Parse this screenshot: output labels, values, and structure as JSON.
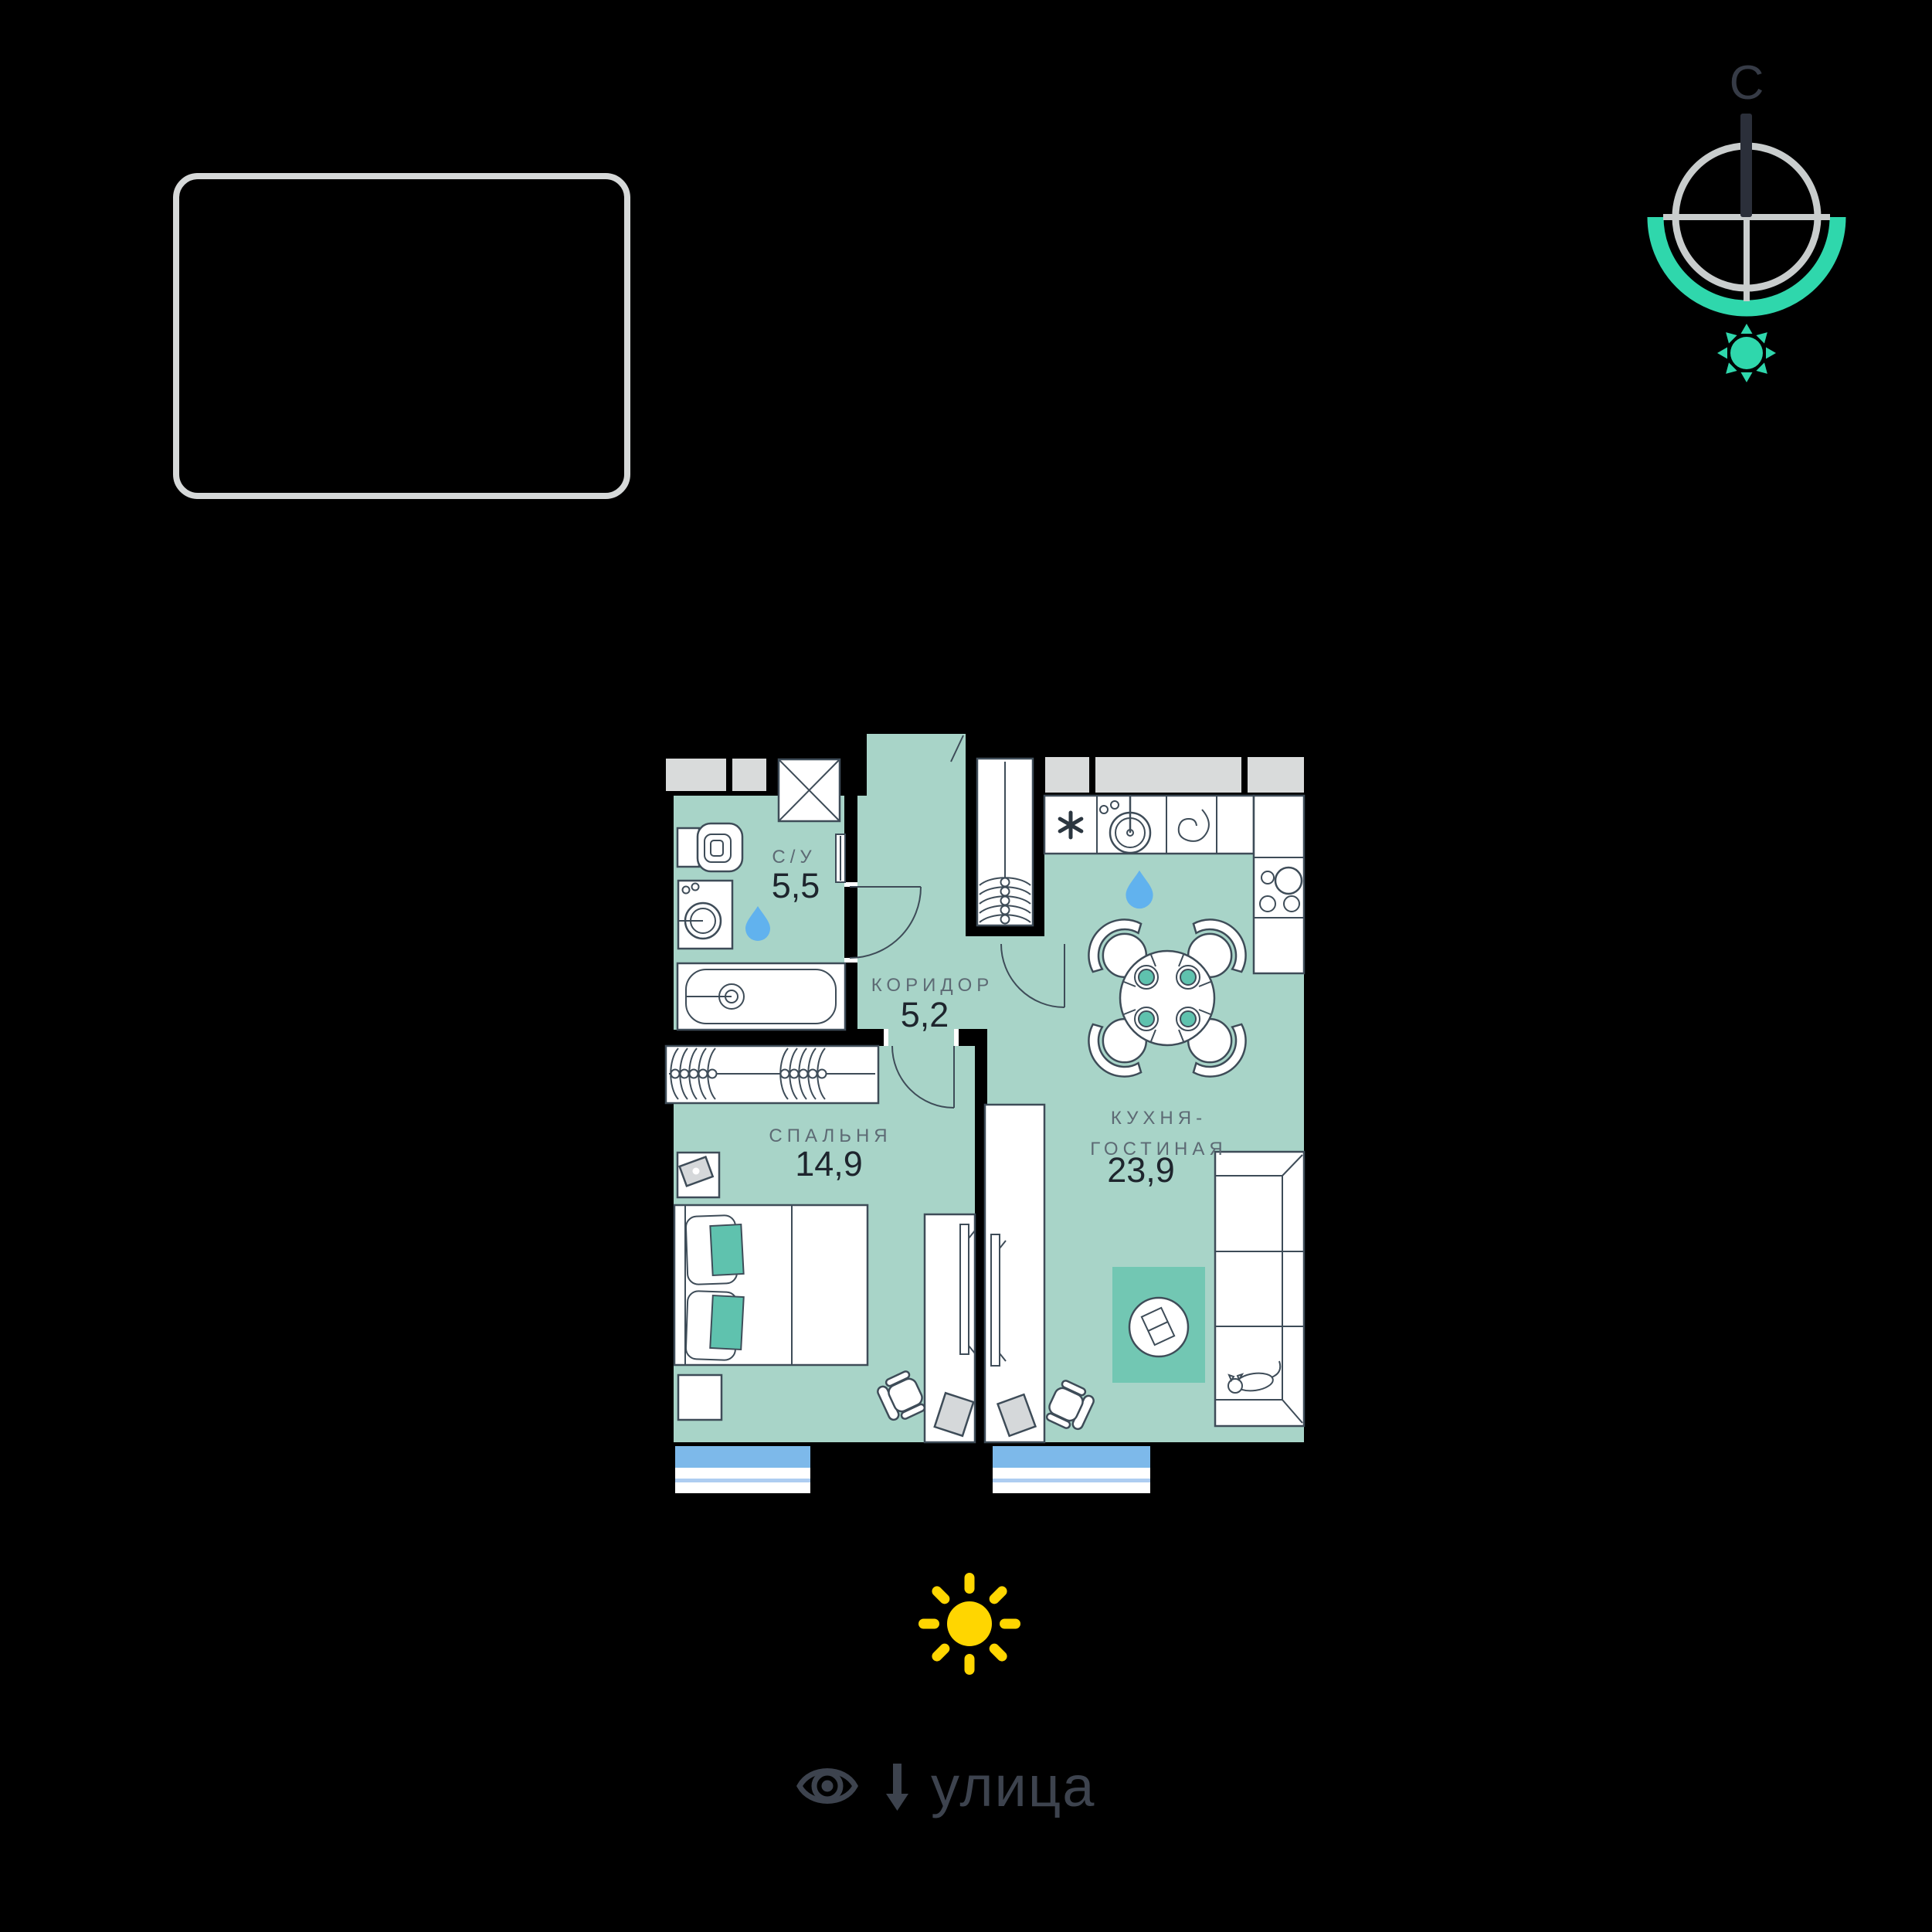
{
  "compass": {
    "north_label": "С"
  },
  "street": {
    "label": "улица"
  },
  "rooms": {
    "bathroom": {
      "name": "С/У",
      "area": "5,5"
    },
    "corridor": {
      "name": "КОРИДОР",
      "area": "5,2"
    },
    "bedroom": {
      "name": "СПАЛЬНЯ",
      "area": "14,9"
    },
    "kitchen_living": {
      "name_line1": "КУХНЯ-",
      "name_line2": "ГОСТИНАЯ",
      "area": "23,9"
    }
  },
  "icons": {
    "compass": "compass-rose-icon",
    "north_sun": "sun-icon-teal",
    "south_sun": "sun-icon-yellow",
    "street_view": "eye-icon",
    "street_direction": "arrow-down-icon",
    "wet_zone": "water-drop-icon"
  },
  "colors": {
    "background": "#000000",
    "floor": "#a8d4c8",
    "rug": "#72c7b3",
    "accent": "#5fc2ae",
    "outline": "#3e4c58",
    "window_blue": "#7db9ea",
    "drop_blue": "#61b2ee",
    "sun_yellow": "#ffd600",
    "compass_teal": "#2fd7ac",
    "compass_gray": "#c9cdcd",
    "label_gray": "#5d6a74",
    "number_dark": "#1e252d",
    "street_text": "#3d434e",
    "info_box_border": "#d6d9d9",
    "shaft_gray": "#d9dbdb"
  }
}
